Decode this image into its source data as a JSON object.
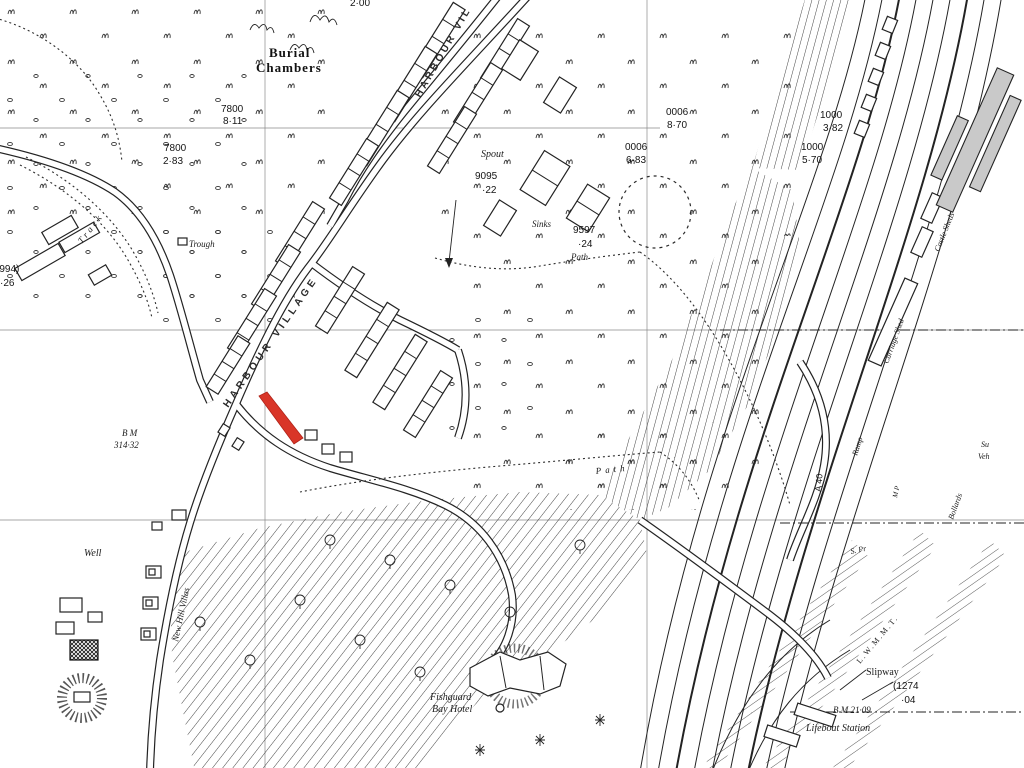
{
  "map": {
    "highlight": {
      "name": "highlighted-plot",
      "color": "#d93528"
    },
    "colors": {
      "ink": "#232323",
      "grid": "#8a8a8a",
      "building_grey": "#c9c9c9",
      "paper": "#ffffff"
    },
    "labels": {
      "burial1": "Burial",
      "burial2": "Chambers",
      "p7800a": "7800",
      "p7800a_v": "8·11",
      "p7800b": "7800",
      "p7800b_v": "2·83",
      "p0006a": "0006",
      "p0006a_v": "8·70",
      "p0006b": "0006",
      "p0006b_v": "6·83",
      "p1000a": "1000",
      "p1000a_v": "3·82",
      "p1000b": "1000",
      "p1000b_v": "5·70",
      "p9095": "9095",
      "p9095_v": "·22",
      "p9597": "9597",
      "p9597_v": "·24",
      "p994": "(994)",
      "p994_v": "·26",
      "p1274": "(1274",
      "p1274_v": "·04",
      "p200": "2·00",
      "spout": "Spout",
      "sinks": "Sinks",
      "path1": "Path",
      "path2": "Path",
      "track": "Track",
      "trough": "Trough",
      "well": "Well",
      "bm1a": "B M",
      "bm1b": "314·32",
      "bm2": "B M 21·09",
      "nhv": "New Hill Villas",
      "street_upper": "HARBOUR VIL",
      "street_lower": "HARBOUR VILLAGE",
      "hotel1": "Fishguard",
      "hotel2": "Bay Hotel",
      "slipway": "Slipway",
      "lifeboat": "Lifeboat Station",
      "castle_sheds": "Castle Sheds",
      "carriage_shed": "Carriage Shed",
      "ramp": "Ramp",
      "bollards": "Bollards",
      "s_pr": "S. Pr",
      "m_p": "M P",
      "su": "Su",
      "veh": "Veh",
      "a40": "A 40",
      "lwmmt": "L.W.M.M.T."
    }
  }
}
